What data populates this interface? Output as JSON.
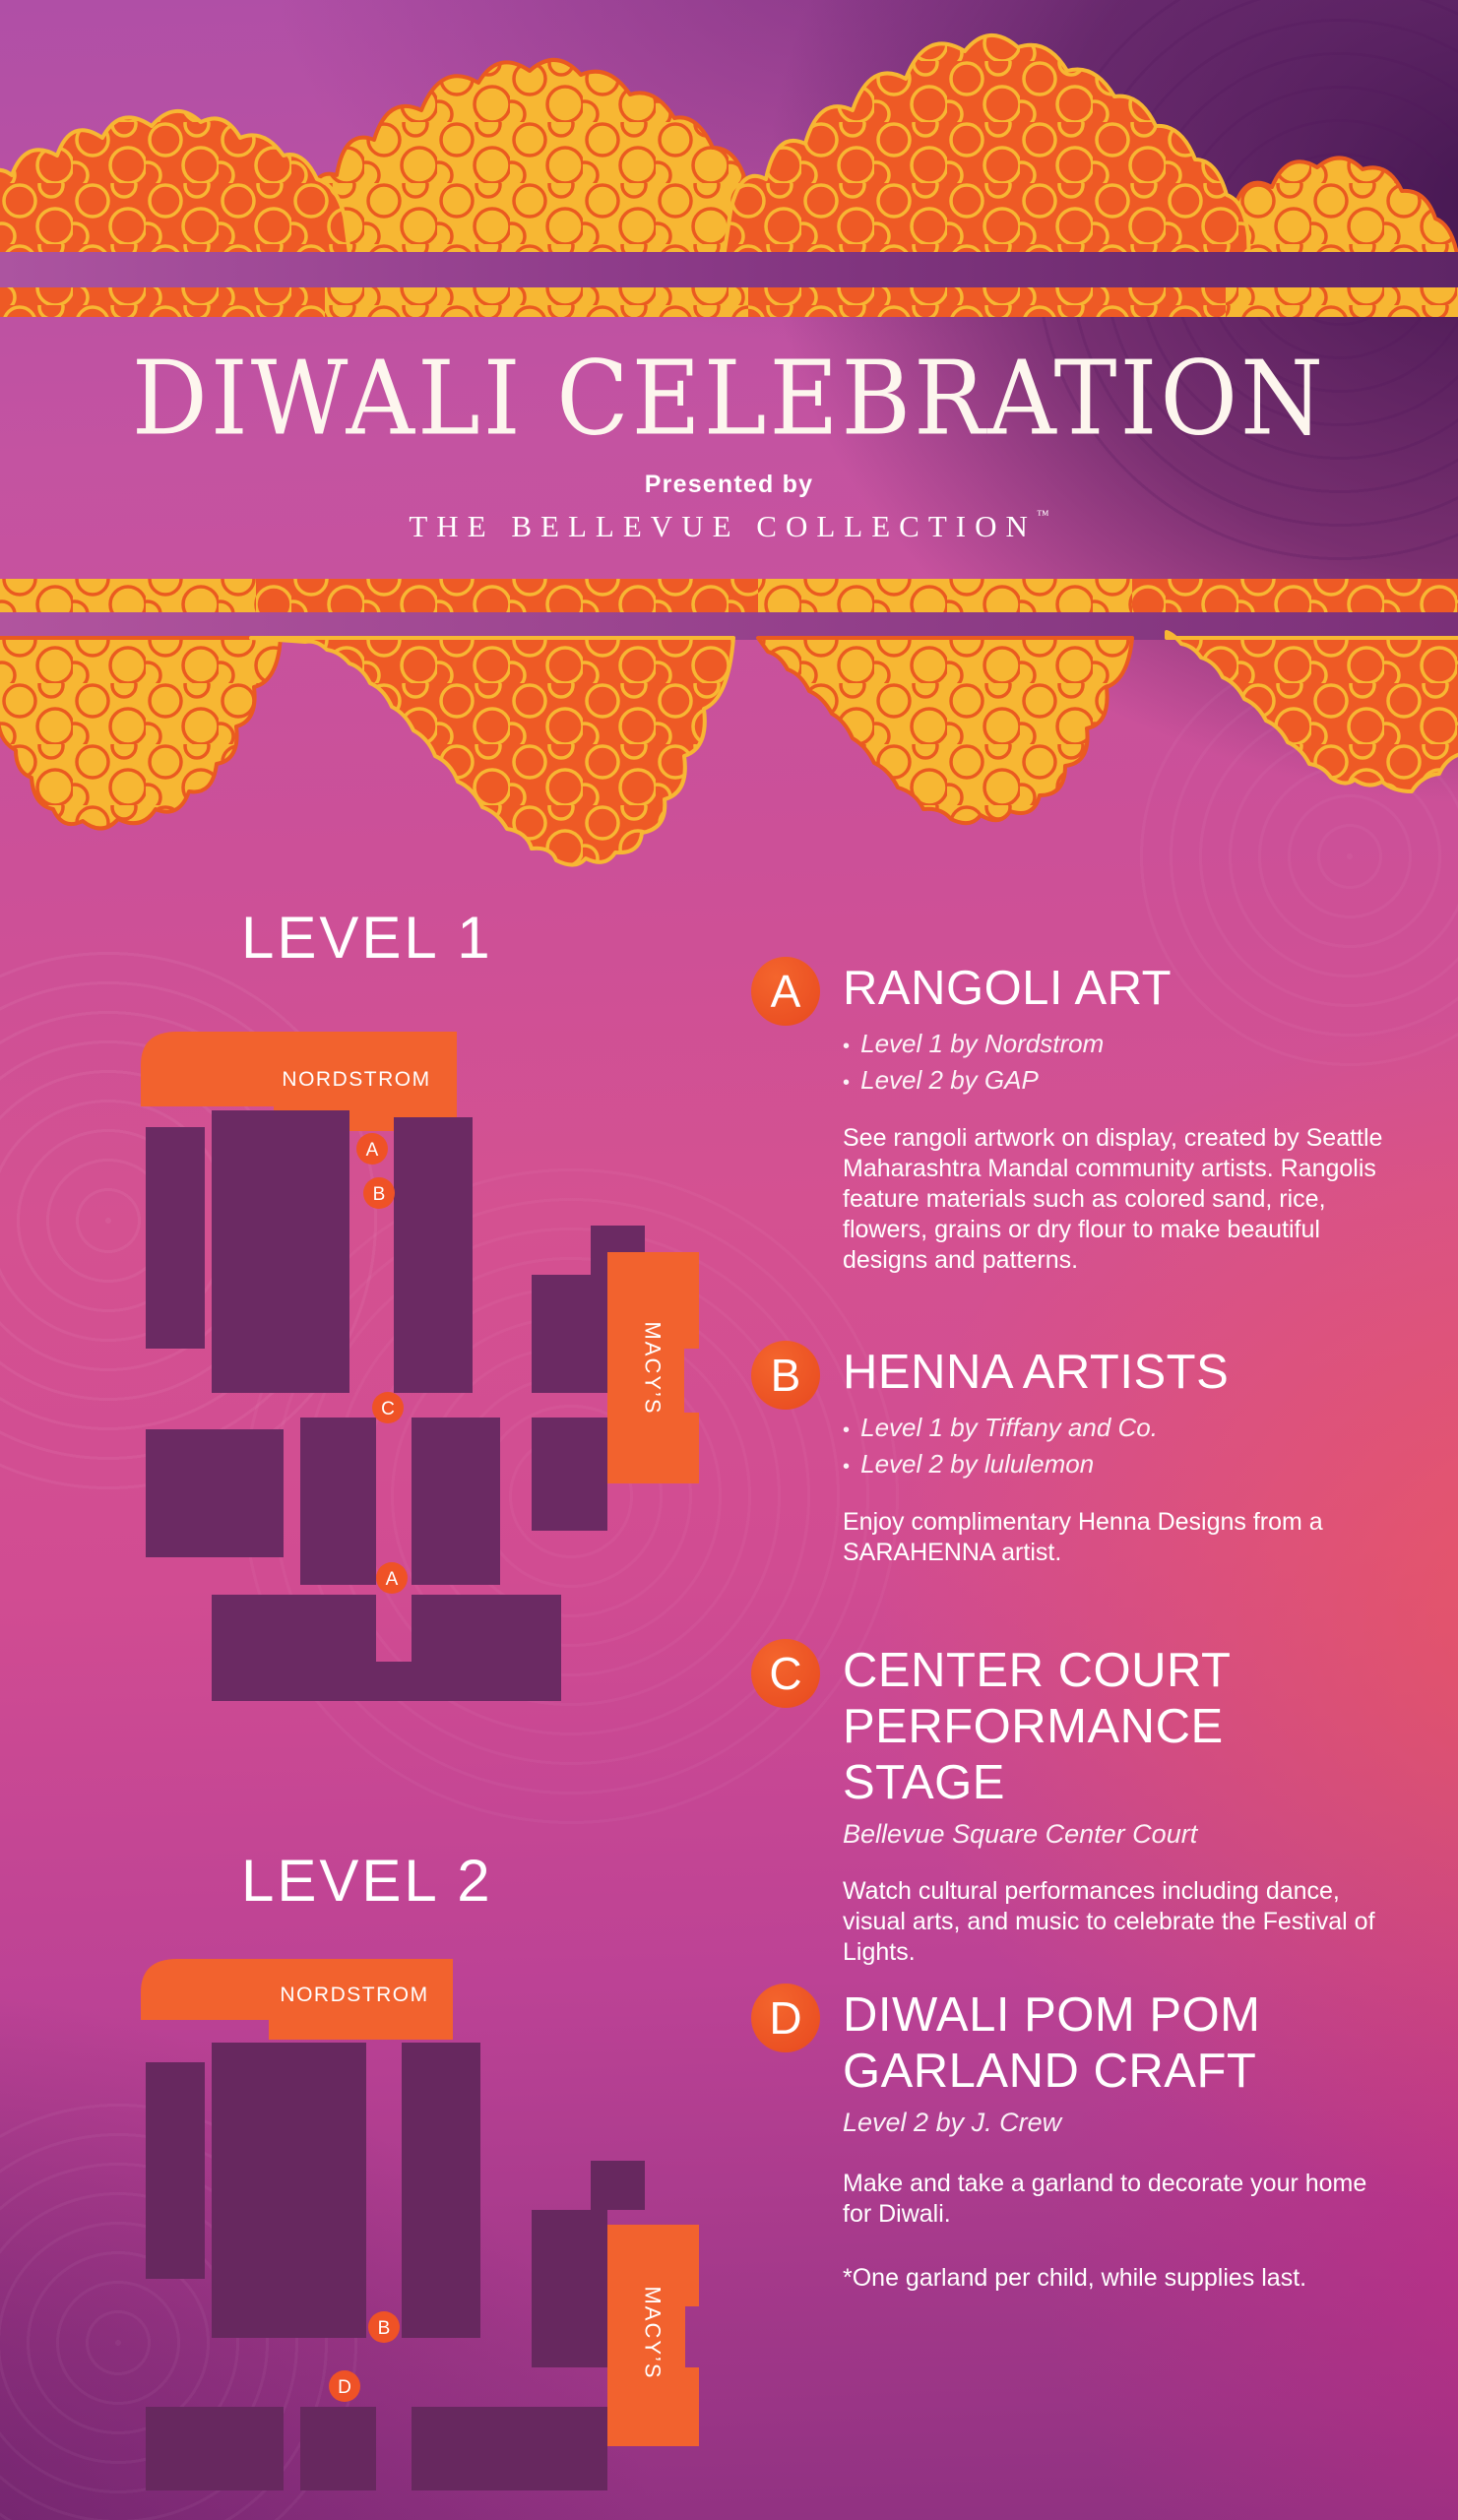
{
  "poster": {
    "title": "DIWALI CELEBRATION",
    "presented_by": "Presented by",
    "brand": "THE BELLEVUE COLLECTION",
    "trademark": "™"
  },
  "levels": [
    {
      "label": "LEVEL 1",
      "stores": {
        "nordstrom": "NORDSTROM",
        "macys": "MACY’S"
      },
      "markers": [
        {
          "letter": "A"
        },
        {
          "letter": "B"
        },
        {
          "letter": "C"
        },
        {
          "letter": "A"
        }
      ]
    },
    {
      "label": "LEVEL 2",
      "stores": {
        "nordstrom": "NORDSTROM",
        "macys": "MACY’S"
      },
      "markers": [
        {
          "letter": "B"
        },
        {
          "letter": "D"
        }
      ]
    }
  ],
  "legend": [
    {
      "letter": "A",
      "title": "RANGOLI ART",
      "bullets": [
        "Level 1 by Nordstrom",
        "Level 2 by GAP"
      ],
      "description": "See rangoli artwork on display, created by Seattle Maharashtra Mandal community artists. Rangolis feature materials such as colored sand, rice, flowers, grains or dry flour to make beautiful designs and patterns."
    },
    {
      "letter": "B",
      "title": "HENNA ARTISTS",
      "bullets": [
        "Level 1 by Tiffany and Co.",
        "Level 2 by lululemon"
      ],
      "description": "Enjoy complimentary Henna Designs from a SARAHENNA artist."
    },
    {
      "letter": "C",
      "title": "CENTER COURT PERFORMANCE STAGE",
      "subtitle": "Bellevue Square Center Court",
      "description": "Watch cultural performances including dance, visual arts, and music to celebrate the Festival of Lights."
    },
    {
      "letter": "D",
      "title": "DIWALI POM POM GARLAND CRAFT",
      "subtitle": "Level 2 by J. Crew",
      "description": "Make and take a garland to decorate your home for Diwali.",
      "note": "*One garland per child, while supplies last."
    }
  ],
  "colors": {
    "accent_orange": "#EF5226",
    "marigold_orange": "#EE5A25",
    "marigold_yellow": "#F7B733",
    "map_purple": "#6B2A63",
    "band_purple": "#8E3A86",
    "background_magenta": "#C4509B"
  }
}
